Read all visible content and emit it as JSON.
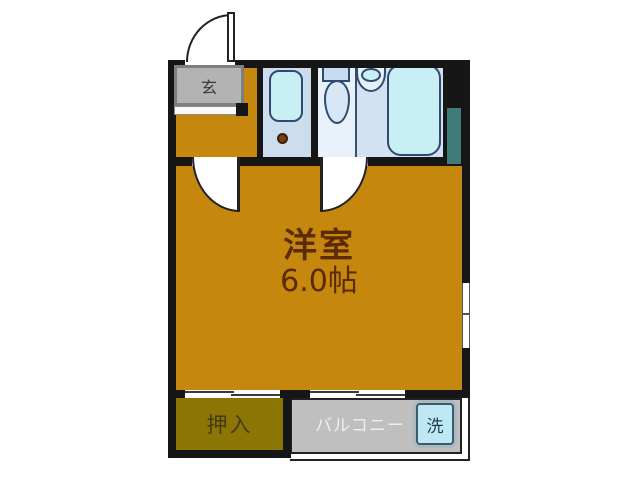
{
  "floorplan": {
    "entrance": {
      "label": "玄"
    },
    "main_room": {
      "name": "洋室",
      "size": "6.0帖"
    },
    "closet": {
      "label": "押入"
    },
    "balcony": {
      "label": "バルコニー"
    },
    "washer": {
      "label": "洗"
    },
    "colors": {
      "wall": "#161616",
      "main_floor": "#c6870e",
      "closet_floor": "#8b7505",
      "entrance_floor": "#b3b3b3",
      "balcony_floor": "#bfbfbf",
      "washbasin_floor": "#ccdded",
      "toilet_floor": "#e9f2fa",
      "bath_floor": "#d3e2f2",
      "fixture_fill": "#c8eff3",
      "fixture_outline": "#2e4a6e",
      "pipe_space": "#3f7d7b",
      "room_label_text": "#5a2b05",
      "washer_fill": "#bfe9f2"
    }
  }
}
